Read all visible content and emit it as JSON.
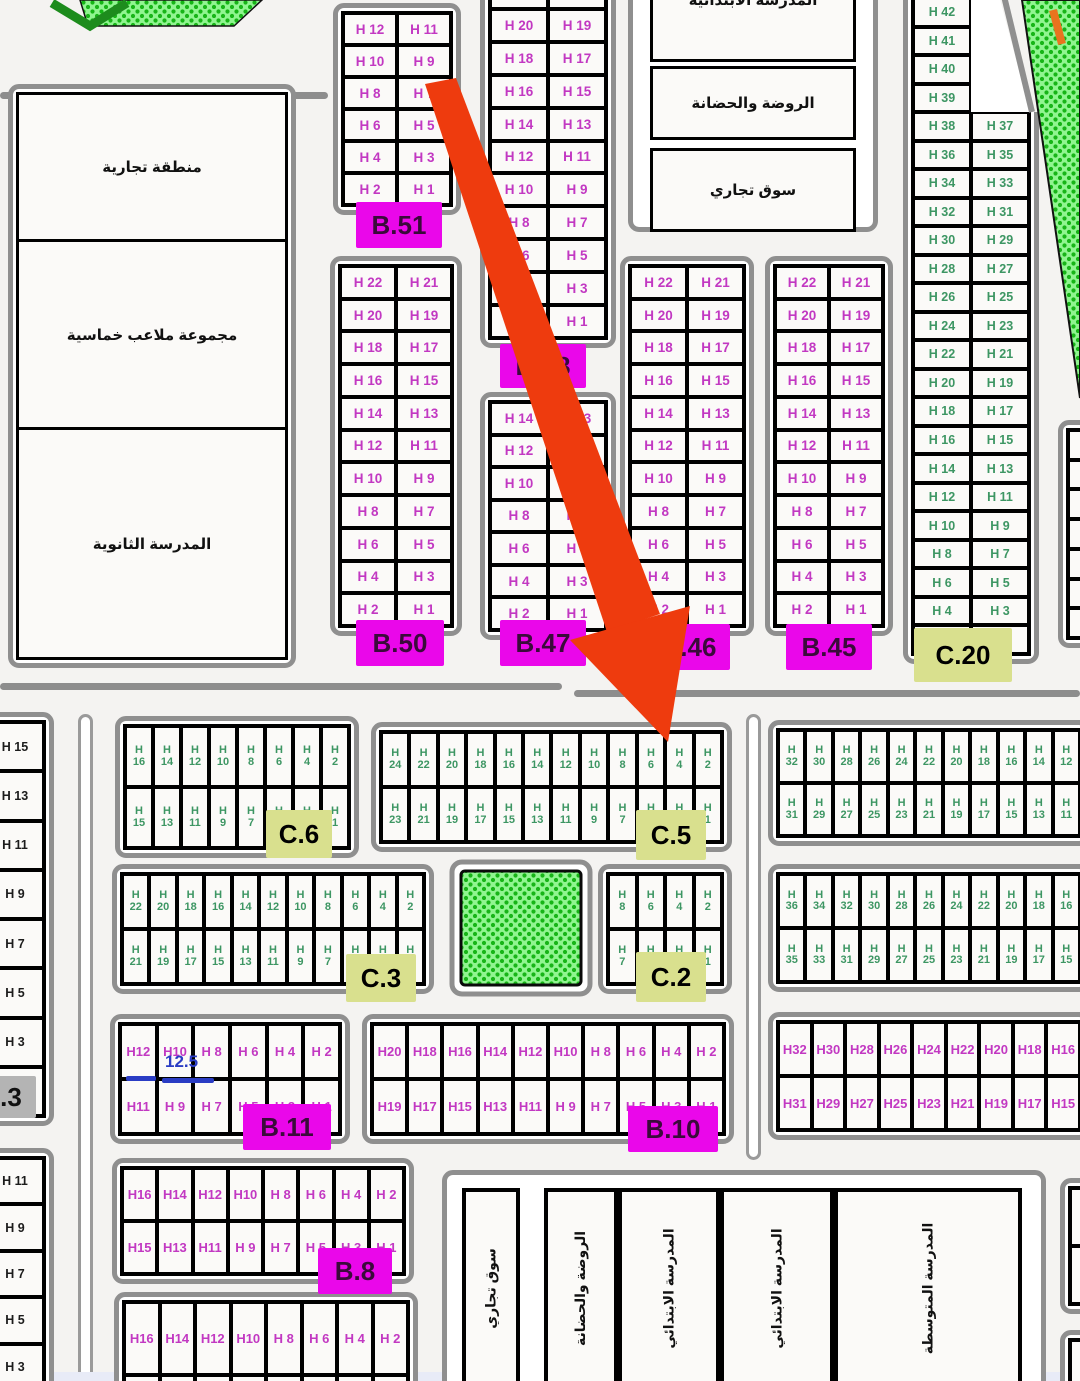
{
  "page": {
    "bg": "#f4f3f1"
  },
  "arrow": {
    "color": "#ee3b0e"
  },
  "annotation": {
    "text": "12.5",
    "color": "#2a3cc4"
  },
  "decor": {
    "hatch_bg": "#90f590",
    "hatch_dot": "#17b517",
    "chevron": "#1d8c1d",
    "orange_mark": "#e8731e",
    "curb_gray": "#8f8f8f"
  },
  "left_complex": {
    "sections": [
      "منطقة تجارية",
      "مجموعة ملاعب خماسية",
      "المدرسة الثانوية"
    ]
  },
  "top_facilities": {
    "boxes": [
      "المدرسة الابتدائية",
      "الروضة والحضانة",
      "سوق تجاري"
    ]
  },
  "schools_bottom": {
    "items": [
      {
        "x": 462,
        "w": 58,
        "label": "سوق تجاري"
      },
      {
        "x": 544,
        "w": 74,
        "label": "الروضة والحضانة"
      },
      {
        "x": 618,
        "w": 102,
        "label": "المدرسة الابتدائي"
      },
      {
        "x": 720,
        "w": 114,
        "label": "المدرسة الابتدائي"
      },
      {
        "x": 834,
        "w": 188,
        "label": "المدرسة المتوسطة"
      }
    ]
  },
  "blocks": [
    {
      "id": "b51",
      "color": "magenta",
      "x": 333,
      "y": 3,
      "w": 128,
      "h": 212,
      "cols": 2,
      "rows": [
        [
          "H 12",
          "H 11"
        ],
        [
          "H 10",
          "H 9"
        ],
        [
          "H 8",
          "H 7"
        ],
        [
          "H 6",
          "H 5"
        ],
        [
          "H 4",
          "H 3"
        ],
        [
          "H 2",
          "H 1"
        ]
      ],
      "label": {
        "text": "B.51",
        "cls": "blabel",
        "x": 356,
        "y": 202,
        "w": 86,
        "h": 46
      }
    },
    {
      "id": "b48",
      "color": "magenta",
      "x": 480,
      "y": -34,
      "w": 136,
      "h": 382,
      "cols": 2,
      "rows": [
        [
          "H 22",
          "H 21"
        ],
        [
          "H 20",
          "H 19"
        ],
        [
          "H 18",
          "H 17"
        ],
        [
          "H 16",
          "H 15"
        ],
        [
          "H 14",
          "H 13"
        ],
        [
          "H 12",
          "H 11"
        ],
        [
          "H 10",
          "H 9"
        ],
        [
          "H 8",
          "H 7"
        ],
        [
          "H 6",
          "H 5"
        ],
        [
          "H 4",
          "H 3"
        ],
        [
          "H 2",
          "H 1"
        ]
      ],
      "label": {
        "text": "B.48",
        "cls": "blabel",
        "x": 500,
        "y": 344,
        "w": 86,
        "h": 44
      }
    },
    {
      "id": "b47",
      "color": "magenta",
      "x": 480,
      "y": 392,
      "w": 136,
      "h": 248,
      "cols": 2,
      "rows": [
        [
          "H 14",
          "H 13"
        ],
        [
          "H 12",
          "H 11"
        ],
        [
          "H 10",
          "H 9"
        ],
        [
          "H 8",
          "H 7"
        ],
        [
          "H 6",
          "H 5"
        ],
        [
          "H 4",
          "H 3"
        ],
        [
          "H 2",
          "H 1"
        ]
      ],
      "label": {
        "text": "B.47",
        "cls": "blabel",
        "x": 500,
        "y": 620,
        "w": 86,
        "h": 46
      }
    },
    {
      "id": "b50",
      "color": "magenta",
      "x": 330,
      "y": 256,
      "w": 132,
      "h": 380,
      "cols": 2,
      "rows": [
        [
          "H 22",
          "H 21"
        ],
        [
          "H 20",
          "H 19"
        ],
        [
          "H 18",
          "H 17"
        ],
        [
          "H 16",
          "H 15"
        ],
        [
          "H 14",
          "H 13"
        ],
        [
          "H 12",
          "H 11"
        ],
        [
          "H 10",
          "H 9"
        ],
        [
          "H 8",
          "H 7"
        ],
        [
          "H 6",
          "H 5"
        ],
        [
          "H 4",
          "H 3"
        ],
        [
          "H 2",
          "H 1"
        ]
      ],
      "label": {
        "text": "B.50",
        "cls": "blabel",
        "x": 356,
        "y": 620,
        "w": 88,
        "h": 46
      }
    },
    {
      "id": "b46",
      "color": "magenta",
      "x": 620,
      "y": 256,
      "w": 134,
      "h": 380,
      "cols": 2,
      "rows": [
        [
          "H 22",
          "H 21"
        ],
        [
          "H 20",
          "H 19"
        ],
        [
          "H 18",
          "H 17"
        ],
        [
          "H 16",
          "H 15"
        ],
        [
          "H 14",
          "H 13"
        ],
        [
          "H 12",
          "H 11"
        ],
        [
          "H 10",
          "H 9"
        ],
        [
          "H 8",
          "H 7"
        ],
        [
          "H 6",
          "H 5"
        ],
        [
          "H 4",
          "H 3"
        ],
        [
          "H 2",
          "H 1"
        ]
      ],
      "label": {
        "text": "B.46",
        "cls": "blabel",
        "x": 648,
        "y": 624,
        "w": 82,
        "h": 46
      }
    },
    {
      "id": "b45",
      "color": "magenta",
      "x": 765,
      "y": 256,
      "w": 128,
      "h": 380,
      "cols": 2,
      "rows": [
        [
          "H 22",
          "H 21"
        ],
        [
          "H 20",
          "H 19"
        ],
        [
          "H 18",
          "H 17"
        ],
        [
          "H 16",
          "H 15"
        ],
        [
          "H 14",
          "H 13"
        ],
        [
          "H 12",
          "H 11"
        ],
        [
          "H 10",
          "H 9"
        ],
        [
          "H 8",
          "H 7"
        ],
        [
          "H 6",
          "H 5"
        ],
        [
          "H 4",
          "H 3"
        ],
        [
          "H 2",
          "H 1"
        ]
      ],
      "label": {
        "text": "B.45",
        "cls": "blabel",
        "x": 786,
        "y": 624,
        "w": 86,
        "h": 46
      }
    },
    {
      "id": "c20",
      "color": "green",
      "fs": 12.5,
      "x": 903,
      "y": -12,
      "w": 136,
      "h": 676,
      "cols": 2,
      "rows": [
        [
          "H 42",
          null
        ],
        [
          "H 41",
          null
        ],
        [
          "H 40",
          null
        ],
        [
          "H 39",
          null
        ],
        [
          "H 38",
          "H 37"
        ],
        [
          "H 36",
          "H 35"
        ],
        [
          "H 34",
          "H 33"
        ],
        [
          "H 32",
          "H 31"
        ],
        [
          "H 30",
          "H 29"
        ],
        [
          "H 28",
          "H 27"
        ],
        [
          "H 26",
          "H 25"
        ],
        [
          "H 24",
          "H 23"
        ],
        [
          "H 22",
          "H 21"
        ],
        [
          "H 20",
          "H 19"
        ],
        [
          "H 18",
          "H 17"
        ],
        [
          "H 16",
          "H 15"
        ],
        [
          "H 14",
          "H 13"
        ],
        [
          "H 12",
          "H 11"
        ],
        [
          "H 10",
          "H 9"
        ],
        [
          "H 8",
          "H 7"
        ],
        [
          "H 6",
          "H 5"
        ],
        [
          "H 4",
          "H 3"
        ],
        [
          "H 2",
          "H 1"
        ]
      ],
      "label": {
        "text": "C.20",
        "cls": "clabel",
        "x": 914,
        "y": 628,
        "w": 98,
        "h": 54
      }
    },
    {
      "id": "edge-right-top",
      "color": "green",
      "x": 1058,
      "y": 420,
      "w": 46,
      "h": 228,
      "cols": 1,
      "rows": [
        [
          ""
        ],
        [
          ""
        ],
        [
          ""
        ],
        [
          ""
        ],
        [
          ""
        ],
        [
          ""
        ],
        [
          ""
        ]
      ]
    },
    {
      "id": "left-col-top",
      "color": "black",
      "fs": 12.5,
      "x": -24,
      "y": 712,
      "w": 78,
      "h": 414,
      "cols": 1,
      "rows": [
        [
          "H 15"
        ],
        [
          "H 13"
        ],
        [
          "H 11"
        ],
        [
          "H 9"
        ],
        [
          "H 7"
        ],
        [
          "H 5"
        ],
        [
          "H 3"
        ],
        [
          "H 1"
        ]
      ],
      "label": {
        "text": ".3",
        "cls": "glabel",
        "x": -14,
        "y": 1076,
        "w": 50,
        "h": 42
      }
    },
    {
      "id": "left-col-bottom",
      "color": "black",
      "fs": 12.5,
      "x": -24,
      "y": 1148,
      "w": 78,
      "h": 252,
      "cols": 1,
      "rows": [
        [
          "H 11"
        ],
        [
          "H 9"
        ],
        [
          "H 7"
        ],
        [
          "H 5"
        ],
        [
          "H 3"
        ]
      ]
    },
    {
      "id": "c6",
      "color": "green",
      "stacked": true,
      "fs": 11,
      "x": 115,
      "y": 716,
      "w": 244,
      "h": 142,
      "cols": 8,
      "rows": [
        [
          "H 16",
          "H 14",
          "H 12",
          "H 10",
          "H 8",
          "H 6",
          "H 4",
          "H 2"
        ],
        [
          "H 15",
          "H 13",
          "H 11",
          "H 9",
          "H 7",
          "H 5",
          "H 3",
          "H 1"
        ]
      ],
      "label": {
        "text": "C.6",
        "cls": "clabel",
        "x": 266,
        "y": 810,
        "w": 66,
        "h": 48
      }
    },
    {
      "id": "c5",
      "color": "green",
      "stacked": true,
      "fs": 11,
      "x": 371,
      "y": 722,
      "w": 361,
      "h": 130,
      "cols": 12,
      "rows": [
        [
          "H 24",
          "H 22",
          "H 20",
          "H 18",
          "H 16",
          "H 14",
          "H 12",
          "H 10",
          "H 8",
          "H 6",
          "H 4",
          "H 2"
        ],
        [
          "H 23",
          "H 21",
          "H 19",
          "H 17",
          "H 15",
          "H 13",
          "H 11",
          "H 9",
          "H 7",
          "H 5",
          "H 3",
          "H 1"
        ]
      ],
      "label": {
        "text": "C.5",
        "cls": "clabel",
        "x": 636,
        "y": 810,
        "w": 70,
        "h": 50
      }
    },
    {
      "id": "band1-right",
      "color": "green",
      "stacked": true,
      "fs": 11,
      "x": 768,
      "y": 720,
      "w": 322,
      "h": 126,
      "cols": 11,
      "rows": [
        [
          "H 32",
          "H 30",
          "H 28",
          "H 26",
          "H 24",
          "H 22",
          "H 20",
          "H 18",
          "H 16",
          "H 14",
          "H 12"
        ],
        [
          "H 31",
          "H 29",
          "H 27",
          "H 25",
          "H 23",
          "H 21",
          "H 19",
          "H 17",
          "H 15",
          "H 13",
          "H 11"
        ]
      ]
    },
    {
      "id": "c3",
      "color": "green",
      "stacked": true,
      "fs": 11,
      "x": 112,
      "y": 864,
      "w": 322,
      "h": 130,
      "cols": 11,
      "rows": [
        [
          "H 22",
          "H 20",
          "H 18",
          "H 16",
          "H 14",
          "H 12",
          "H 10",
          "H 8",
          "H 6",
          "H 4",
          "H 2"
        ],
        [
          "H 21",
          "H 19",
          "H 17",
          "H 15",
          "H 13",
          "H 11",
          "H 9",
          "H 7",
          "H 5",
          "H 3",
          "H 1"
        ]
      ],
      "label": {
        "text": "C.3",
        "cls": "clabel",
        "x": 346,
        "y": 954,
        "w": 70,
        "h": 48
      }
    },
    {
      "id": "c2",
      "color": "green",
      "stacked": true,
      "fs": 11,
      "x": 598,
      "y": 864,
      "w": 134,
      "h": 130,
      "cols": 4,
      "rows": [
        [
          "H 8",
          "H 6",
          "H 4",
          "H 2"
        ],
        [
          "H 7",
          "H 5",
          "H 3",
          "H 1"
        ]
      ],
      "label": {
        "text": "C.2",
        "cls": "clabel",
        "x": 636,
        "y": 952,
        "w": 70,
        "h": 50
      }
    },
    {
      "id": "band2-right",
      "color": "green",
      "stacked": true,
      "fs": 11,
      "x": 768,
      "y": 864,
      "w": 322,
      "h": 128,
      "cols": 11,
      "rows": [
        [
          "H 36",
          "H 34",
          "H 32",
          "H 30",
          "H 28",
          "H 26",
          "H 24",
          "H 22",
          "H 20",
          "H 18",
          "H 16"
        ],
        [
          "H 35",
          "H 33",
          "H 31",
          "H 29",
          "H 27",
          "H 25",
          "H 23",
          "H 21",
          "H 19",
          "H 17",
          "H 15"
        ]
      ]
    },
    {
      "id": "b11",
      "color": "magenta",
      "fs": 13,
      "x": 110,
      "y": 1014,
      "w": 240,
      "h": 130,
      "cols": 6,
      "rows": [
        [
          "H12",
          "H10",
          "H 8",
          "H 6",
          "H 4",
          "H 2"
        ],
        [
          "H11",
          "H 9",
          "H 7",
          "H 5",
          "H 3",
          "H 1"
        ]
      ],
      "label": {
        "text": "B.11",
        "cls": "blabel",
        "x": 243,
        "y": 1104,
        "w": 88,
        "h": 46
      }
    },
    {
      "id": "b10",
      "color": "magenta",
      "fs": 13,
      "x": 362,
      "y": 1014,
      "w": 372,
      "h": 130,
      "cols": 10,
      "rows": [
        [
          "H20",
          "H18",
          "H16",
          "H14",
          "H12",
          "H10",
          "H 8",
          "H 6",
          "H 4",
          "H 2"
        ],
        [
          "H19",
          "H17",
          "H15",
          "H13",
          "H11",
          "H 9",
          "H 7",
          "H 5",
          "H 3",
          "H 1"
        ]
      ],
      "label": {
        "text": "B.10",
        "cls": "blabel",
        "x": 628,
        "y": 1106,
        "w": 90,
        "h": 46
      }
    },
    {
      "id": "band3-right",
      "color": "magenta",
      "fs": 13,
      "x": 768,
      "y": 1012,
      "w": 322,
      "h": 128,
      "cols": 9,
      "rows": [
        [
          "H32",
          "H30",
          "H28",
          "H26",
          "H24",
          "H22",
          "H20",
          "H18",
          "H16"
        ],
        [
          "H31",
          "H29",
          "H27",
          "H25",
          "H23",
          "H21",
          "H19",
          "H17",
          "H15"
        ]
      ]
    },
    {
      "id": "b8",
      "color": "magenta",
      "fs": 13,
      "x": 112,
      "y": 1158,
      "w": 302,
      "h": 126,
      "cols": 8,
      "rows": [
        [
          "H16",
          "H14",
          "H12",
          "H10",
          "H 8",
          "H 6",
          "H 4",
          "H 2"
        ],
        [
          "H15",
          "H13",
          "H11",
          "H 9",
          "H 7",
          "H 5",
          "H 3",
          "H 1"
        ]
      ],
      "label": {
        "text": "B.8",
        "cls": "blabel",
        "x": 318,
        "y": 1248,
        "w": 74,
        "h": 46
      }
    },
    {
      "id": "b8-south",
      "color": "magenta",
      "fs": 13,
      "x": 114,
      "y": 1292,
      "w": 304,
      "h": 150,
      "cols": 8,
      "rows": [
        [
          "H16",
          "H14",
          "H12",
          "H10",
          "H 8",
          "H 6",
          "H 4",
          "H 2"
        ],
        [
          "",
          "",
          "",
          "",
          "",
          "",
          "",
          ""
        ]
      ]
    },
    {
      "id": "edge-right-bottom-a",
      "color": "magenta",
      "x": 1060,
      "y": 1178,
      "w": 60,
      "h": 136,
      "cols": 1,
      "rows": [
        [
          ""
        ],
        [
          ""
        ]
      ]
    },
    {
      "id": "edge-right-bottom-b",
      "color": "magenta",
      "x": 1060,
      "y": 1330,
      "w": 60,
      "h": 110,
      "cols": 1,
      "rows": [
        [
          ""
        ],
        [
          ""
        ]
      ]
    }
  ]
}
